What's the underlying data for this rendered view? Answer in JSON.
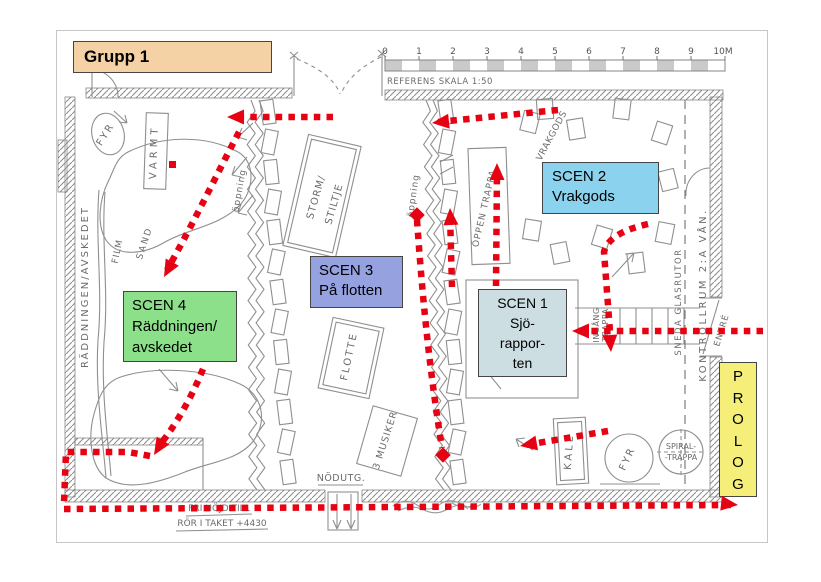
{
  "header": {
    "group_label": "Grupp 1",
    "box_color": "#f5d2a5"
  },
  "scale": {
    "caption": "REFERENS SKALA 1:50",
    "ticks": [
      "0",
      "1",
      "2",
      "3",
      "4",
      "5",
      "6",
      "7",
      "8",
      "9",
      "10M"
    ]
  },
  "scenes": {
    "scen1": {
      "title": "SCEN 1",
      "line1": "Sjö-",
      "line2": "rappor-",
      "line3": "ten",
      "color": "#ccdee2"
    },
    "scen2": {
      "title": "SCEN 2",
      "subtitle": "Vrakgods",
      "color": "#8bd2ee"
    },
    "scen3": {
      "title": "SCEN 3",
      "subtitle": "På flotten",
      "color": "#96a1e0"
    },
    "scen4": {
      "title": "SCEN 4",
      "line1": "Räddningen/",
      "line2": "avskedet",
      "color": "#8ce08a"
    },
    "prolog": {
      "letters": [
        "P",
        "R",
        "O",
        "L",
        "O",
        "G"
      ],
      "color": "#f5ef7a"
    }
  },
  "route_color": "#e60212",
  "annotations": {
    "fyr_top": "FYR",
    "varmt": "VARMT",
    "raddningen_wall": "RÄDDNINGEN/AVSKEDET",
    "film_top": "FILM",
    "sand_top": "SAND",
    "oppning_left": "öppning",
    "oppning_right": "öppning",
    "storm": "STORM/",
    "stiltje": "STILTJE",
    "flotte": "FLOTTE",
    "musiker": "3 MUSIKER",
    "oppen_trappa": "ÖPPEN TRAPPA",
    "vrakgods_sketch": "VRAKGODS",
    "nodutg": "NÖDUTG.",
    "kall": "KALL",
    "fyr_bottom": "FYR",
    "spiral_line1": "SPIRAL-",
    "spiral_line2": "-TRAPPA",
    "kontrollrum": "KONTROLLRUM 2:A VÅN.",
    "sneda_glas": "SNEDA GLASRUTOR",
    "entre": "ENTRÉ",
    "ingang": "INGÅNG",
    "ingang_trappa": "TRAPPA",
    "fri_hojd_line1": "FRI HÖJD TILL",
    "fri_hojd_line2": "RÖR I TAKET +4430"
  }
}
